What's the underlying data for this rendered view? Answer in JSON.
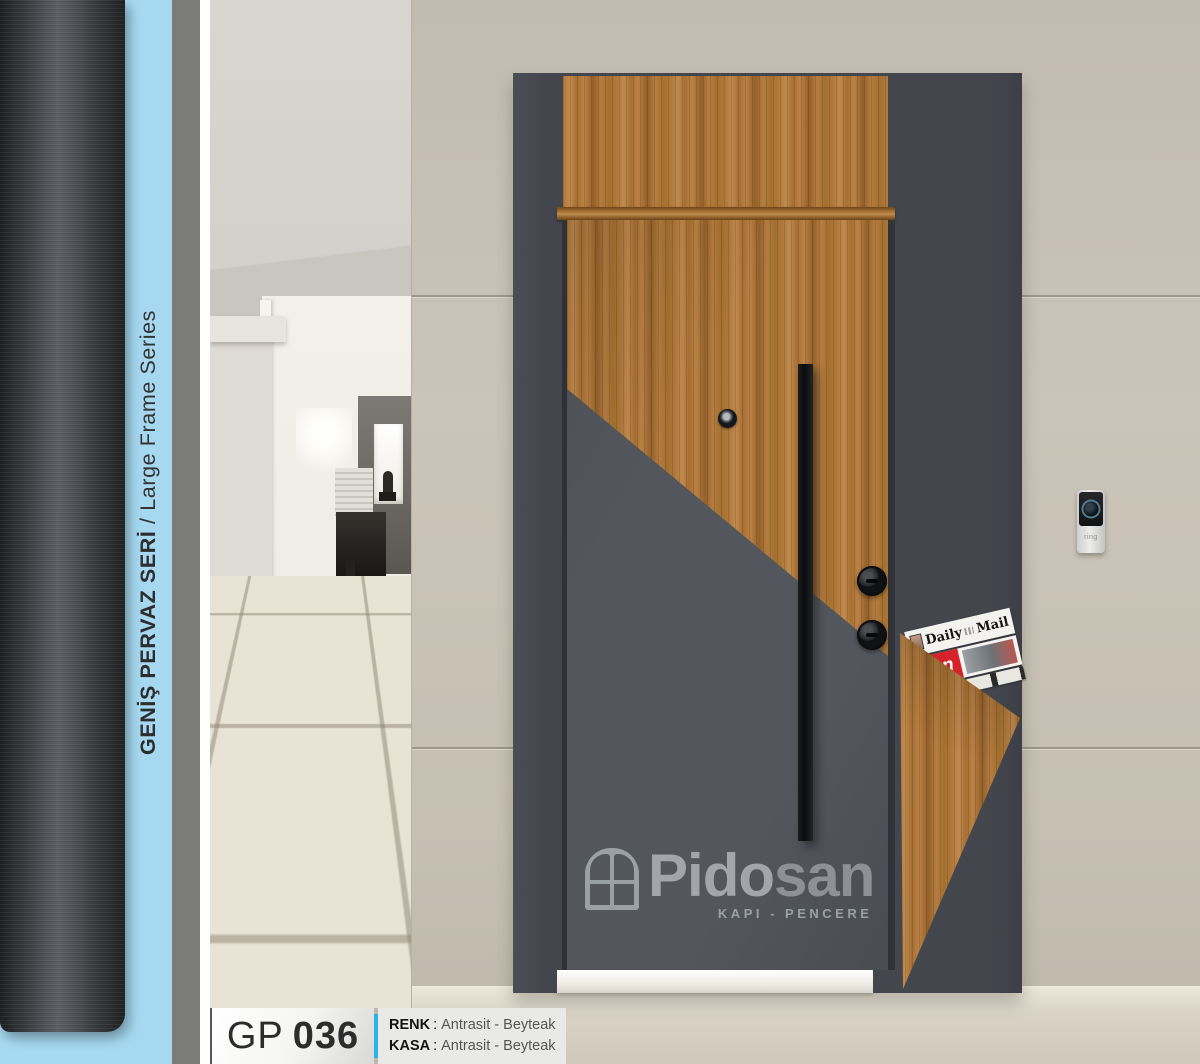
{
  "sidebar": {
    "series_title_tr": "GENİŞ PERVAZ SERİ",
    "series_separator": " / ",
    "series_title_en": "Large Frame Series",
    "accent_color": "#a6d9f1"
  },
  "door": {
    "logo_brand_a": "Pido",
    "logo_brand_b": "san",
    "logo_tagline": "KAPI - PENCERE"
  },
  "newsstand": {
    "paper1_word1": "Daily",
    "paper1_word2": "Mail",
    "paper2_title": "Sun"
  },
  "doorbell": {
    "brand": "ring"
  },
  "footer": {
    "model_prefix": "GP",
    "model_number": "036",
    "spec1_label": "RENK",
    "spec1_sep": ":",
    "spec1_value": "Antrasit - Beyteak",
    "spec2_label": "KASA",
    "spec2_sep": ":",
    "spec2_value": "Antrasit - Beyteak",
    "divider_color": "#2bb3e9"
  },
  "colors": {
    "anthracite": "#43474d",
    "wood": "#b1793c",
    "wall_beige": "#c6bfb3"
  }
}
